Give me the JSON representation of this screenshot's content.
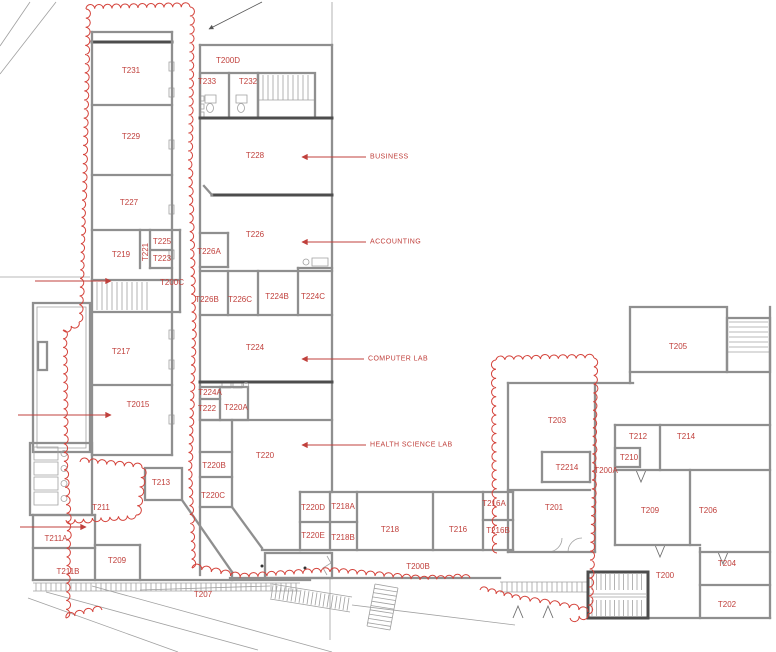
{
  "drawing_title": "Building T second floor plan",
  "colors": {
    "room_label_red": "#c0403c",
    "revision_cloud_red": "#d4423a",
    "wall_gray": "#8f8f8f"
  },
  "rooms": [
    {
      "label": "T231",
      "x": 131,
      "y": 71
    },
    {
      "label": "T229",
      "x": 131,
      "y": 137
    },
    {
      "label": "T227",
      "x": 129,
      "y": 203
    },
    {
      "label": "T219",
      "x": 121,
      "y": 255
    },
    {
      "label": "T225",
      "x": 162,
      "y": 242
    },
    {
      "label": "T223",
      "x": 162,
      "y": 259
    },
    {
      "label": "T221",
      "x": 146,
      "y": 252,
      "rot": -90
    },
    {
      "label": "T200C",
      "x": 172,
      "y": 283
    },
    {
      "label": "T217",
      "x": 121,
      "y": 352
    },
    {
      "label": "T2015",
      "x": 138,
      "y": 405
    },
    {
      "label": "T213",
      "x": 161,
      "y": 483
    },
    {
      "label": "T211",
      "x": 101,
      "y": 508
    },
    {
      "label": "T211A",
      "x": 56,
      "y": 539
    },
    {
      "label": "T211B",
      "x": 68,
      "y": 572
    },
    {
      "label": "T209",
      "x": 117,
      "y": 561
    },
    {
      "label": "T207",
      "x": 203,
      "y": 595
    },
    {
      "label": "T200D",
      "x": 228,
      "y": 61
    },
    {
      "label": "T233",
      "x": 207,
      "y": 82
    },
    {
      "label": "T232",
      "x": 248,
      "y": 82
    },
    {
      "label": "T228",
      "x": 255,
      "y": 156
    },
    {
      "label": "T226",
      "x": 255,
      "y": 235
    },
    {
      "label": "T226A",
      "x": 209,
      "y": 252
    },
    {
      "label": "T226B",
      "x": 207,
      "y": 300
    },
    {
      "label": "T226C",
      "x": 240,
      "y": 300
    },
    {
      "label": "T224B",
      "x": 277,
      "y": 297
    },
    {
      "label": "T224C",
      "x": 313,
      "y": 297
    },
    {
      "label": "T224",
      "x": 255,
      "y": 348
    },
    {
      "label": "T224A",
      "x": 210,
      "y": 393
    },
    {
      "label": "T222",
      "x": 207,
      "y": 409
    },
    {
      "label": "T220A",
      "x": 236,
      "y": 408
    },
    {
      "label": "T220",
      "x": 265,
      "y": 456
    },
    {
      "label": "T220B",
      "x": 214,
      "y": 466
    },
    {
      "label": "T220C",
      "x": 213,
      "y": 496
    },
    {
      "label": "T220D",
      "x": 313,
      "y": 508
    },
    {
      "label": "T218A",
      "x": 343,
      "y": 507
    },
    {
      "label": "T220E",
      "x": 313,
      "y": 536
    },
    {
      "label": "T218B",
      "x": 343,
      "y": 538
    },
    {
      "label": "T218",
      "x": 390,
      "y": 530
    },
    {
      "label": "T216",
      "x": 458,
      "y": 530
    },
    {
      "label": "T216A",
      "x": 494,
      "y": 504
    },
    {
      "label": "T216B",
      "x": 498,
      "y": 531
    },
    {
      "label": "T200B",
      "x": 418,
      "y": 567
    },
    {
      "label": "T205",
      "x": 678,
      "y": 347
    },
    {
      "label": "T203",
      "x": 557,
      "y": 421
    },
    {
      "label": "T2214",
      "x": 567,
      "y": 468
    },
    {
      "label": "T200A",
      "x": 606,
      "y": 471
    },
    {
      "label": "T212",
      "x": 638,
      "y": 437
    },
    {
      "label": "T214",
      "x": 686,
      "y": 437
    },
    {
      "label": "T210",
      "x": 629,
      "y": 458
    },
    {
      "label": "T201",
      "x": 554,
      "y": 508
    },
    {
      "label": "T209",
      "x": 650,
      "y": 511
    },
    {
      "label": "T206",
      "x": 708,
      "y": 511
    },
    {
      "label": "T204",
      "x": 727,
      "y": 564
    },
    {
      "label": "T200",
      "x": 665,
      "y": 576
    },
    {
      "label": "T202",
      "x": 727,
      "y": 605
    }
  ],
  "annotations": [
    {
      "label": "BUSINESS",
      "x": 370,
      "y": 157
    },
    {
      "label": "ACCOUNTING",
      "x": 370,
      "y": 242
    },
    {
      "label": "COMPUTER LAB",
      "x": 368,
      "y": 359
    },
    {
      "label": "HEALTH SCIENCE LAB",
      "x": 370,
      "y": 445
    }
  ]
}
